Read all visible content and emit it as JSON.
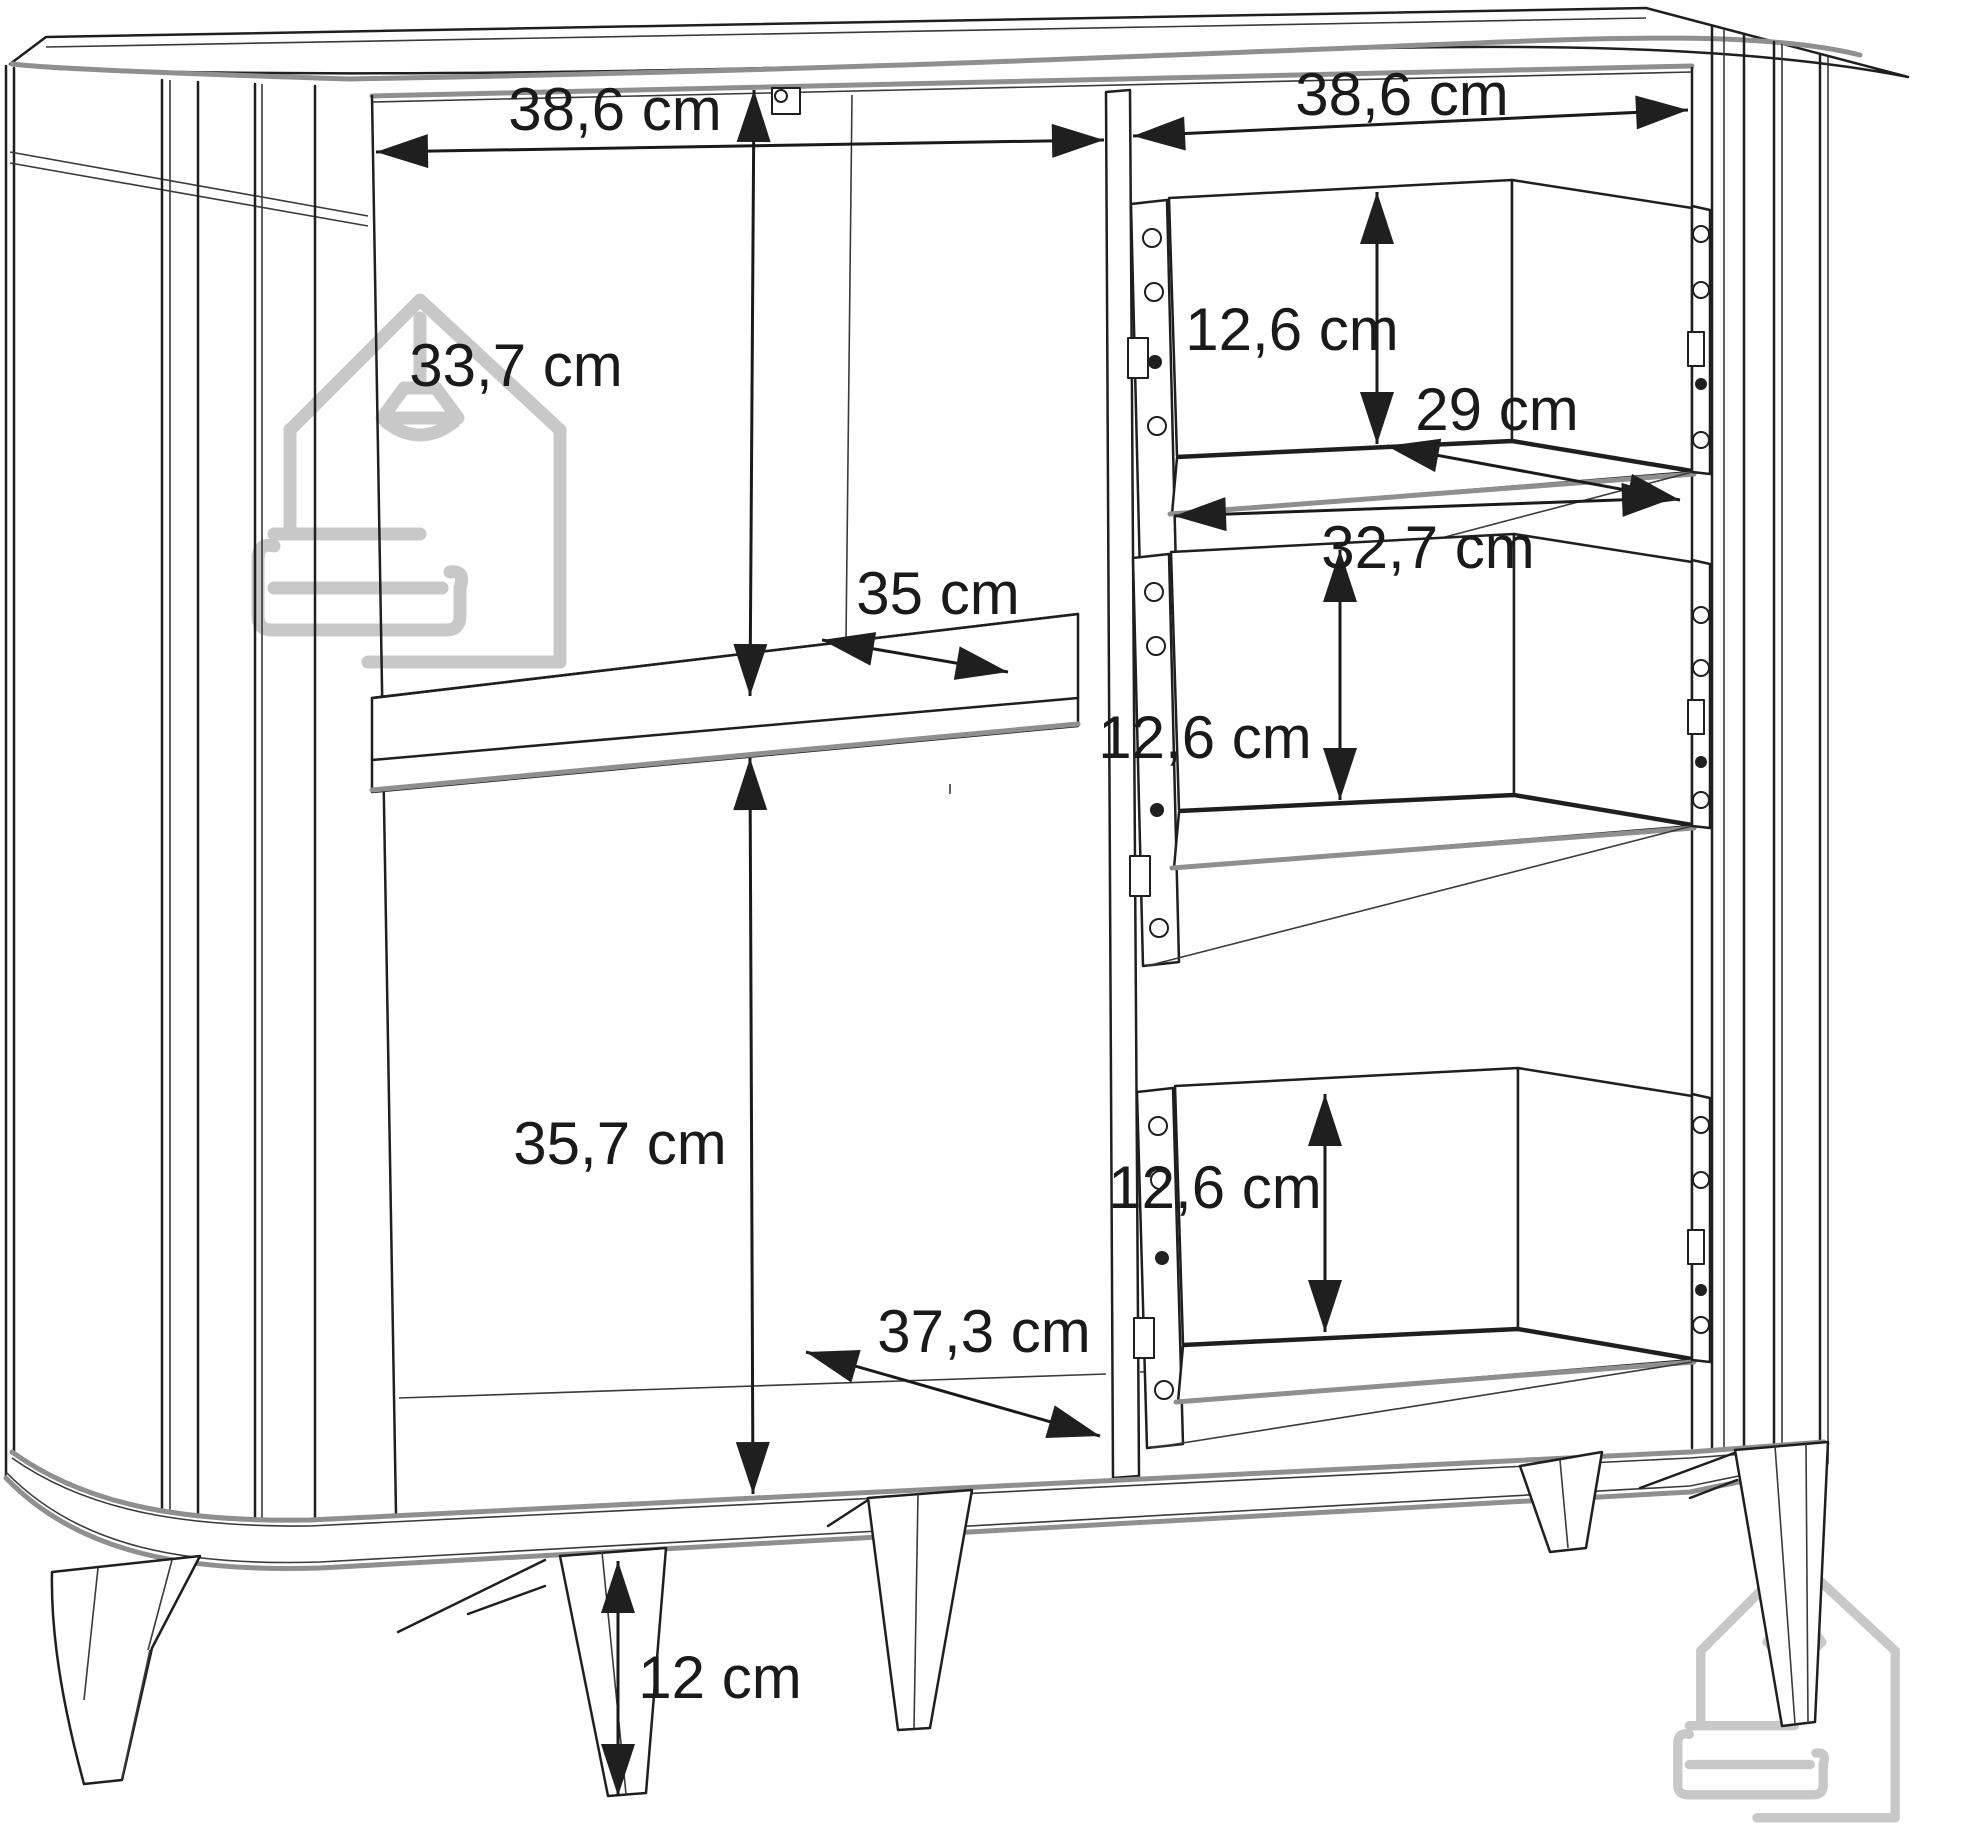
{
  "diagram": {
    "type": "furniture-dimension-drawing",
    "subject": "highboard cabinet with left shelf compartment and three right-hand drawers",
    "unit": "cm",
    "line_color": "#1f1f1f",
    "edge_gray": "#8f8f8f",
    "watermark_color": "#c8c8c8",
    "labels": {
      "left_opening_width": "38,6 cm",
      "right_opening_width": "38,6 cm",
      "upper_left_height": "33,7 cm",
      "shelf_depth": "35 cm",
      "lower_left_height": "35,7 cm",
      "bottom_depth": "37,3 cm",
      "drawer_top_height": "12,6 cm",
      "drawer_middle_height": "12,6 cm",
      "drawer_bottom_height": "12,6 cm",
      "drawer_side_depth": "29 cm",
      "drawer_bottom_width": "32,7 cm",
      "leg_height": "12 cm"
    }
  }
}
